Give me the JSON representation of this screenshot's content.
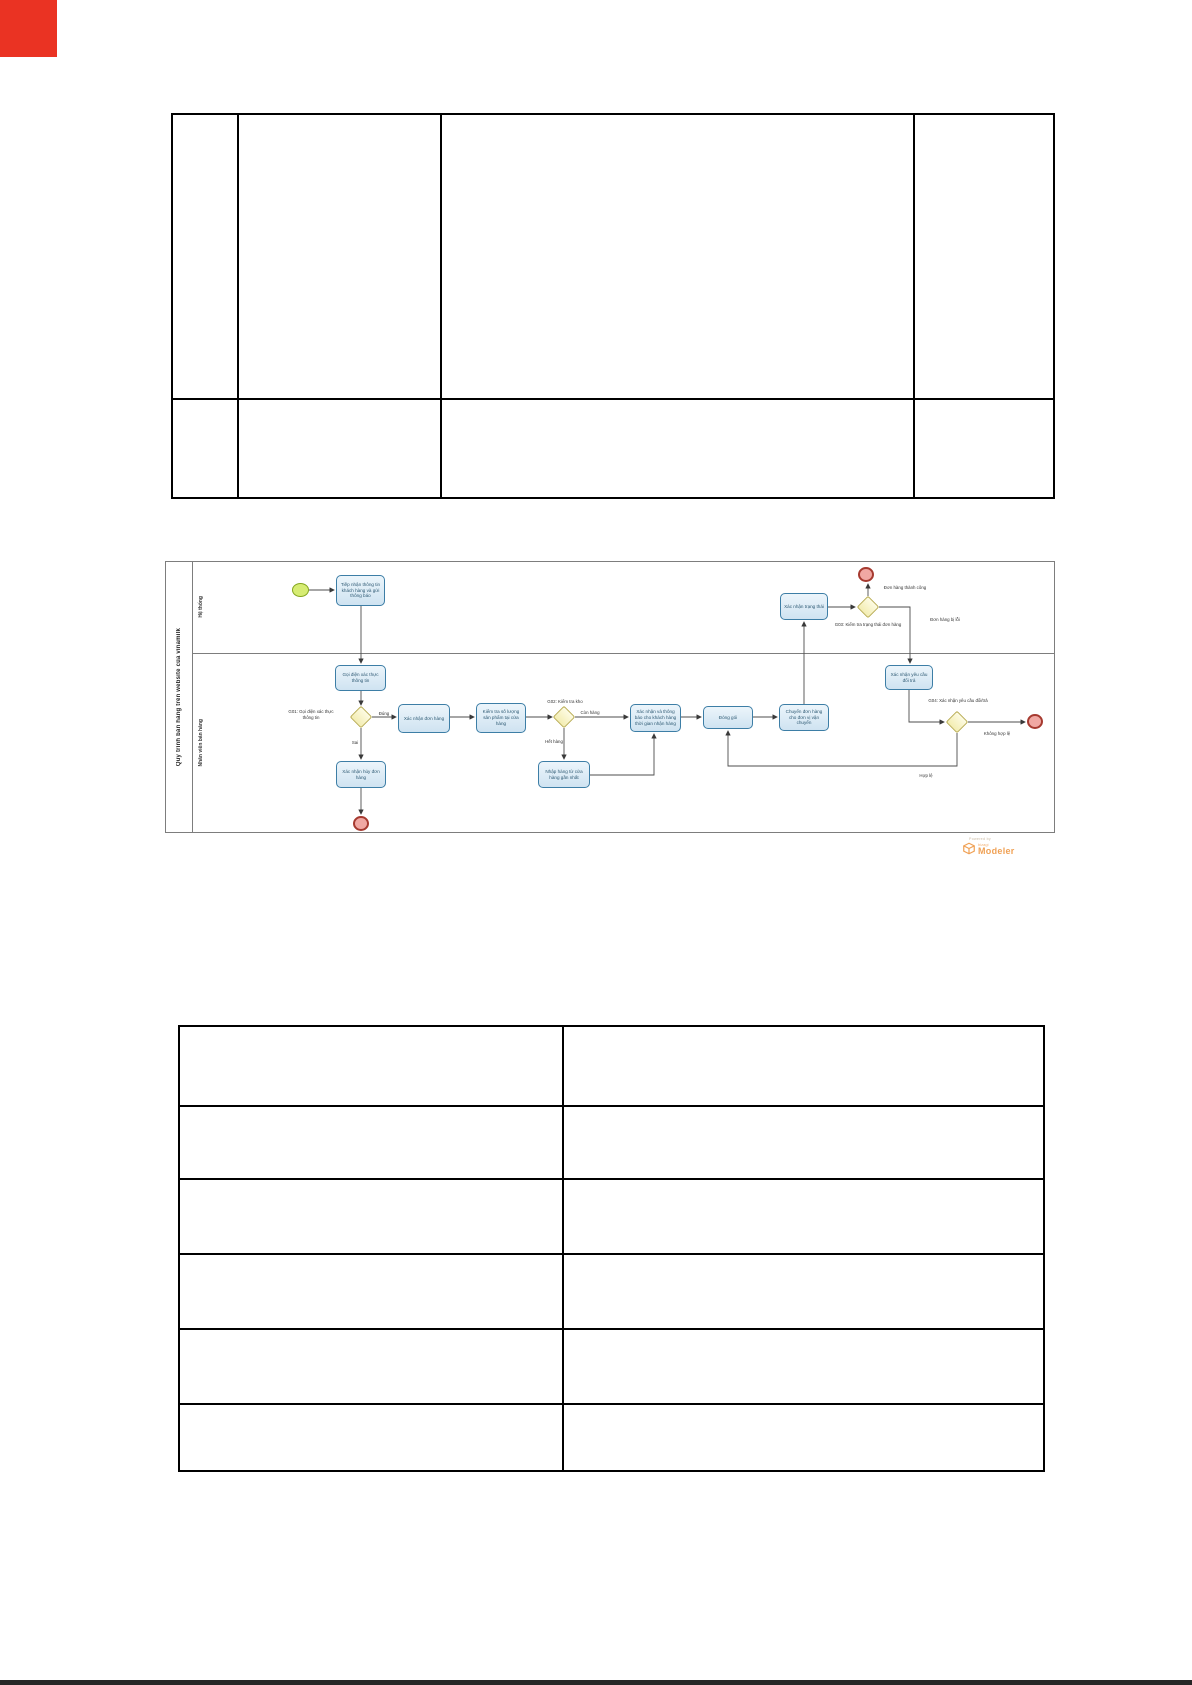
{
  "page": {
    "background": "#ffffff",
    "top_left_marker_color": "#ea3323",
    "bottom_bar_color": "#262626"
  },
  "top_table": {
    "rows": 2,
    "columns": 4,
    "all_cells_empty": true
  },
  "bottom_table": {
    "rows": 6,
    "columns": 2,
    "all_cells_empty": true
  },
  "diagram": {
    "pool_title": "Quy trình bán hàng trên website của vinamilk",
    "lanes": [
      "Hệ thống",
      "Nhân viên bán hàng"
    ],
    "tasks": {
      "t1": "Tiếp nhận thông tin khách hàng và gửi thông báo",
      "t2": "Gọi điện xác thực thông tin",
      "t3": "Xác nhận đơn hàng",
      "t4": "Kiểm tra số lượng sản phẩm tại cửa hàng",
      "t5": "Xác nhận và thông báo cho khách hàng thời gian nhận hàng",
      "t6": "Đóng gói",
      "t7": "Chuyển đơn hàng cho đơn vị vận chuyển",
      "t8": "Xác nhận trạng thái",
      "t9": "Xác nhận yêu cầu đổi trả",
      "t10": "Nhập hàng từ cửa hàng gần nhất",
      "t11": "Xác nhận hủy đơn hàng"
    },
    "gateway_captions": {
      "g01": "G01: Gọi điện xác thực thông tin",
      "g02": "G02: Kiểm tra kho",
      "g03": "G03: Kiểm tra trạng thái đơn hàng",
      "g04": "G04: Xác nhận yêu cầu đổi/trả"
    },
    "edge_labels": {
      "dung": "Đúng",
      "sai": "Sai",
      "con_hang": "Còn hàng",
      "het_hang": "Hết hàng",
      "don_hang_thanh_cong": "Đơn hàng thành công",
      "don_hang_bi_loi": "Đơn hàng bị lỗi",
      "khong_hop_le": "Không hợp lệ",
      "hop_le": "Hợp lệ"
    },
    "colors": {
      "task_fill": "#d9e9f4",
      "task_border": "#3d7ea6",
      "gateway_fill": "#f7f2c0",
      "gateway_border": "#b8ab4f",
      "start_event_fill": "#d6ec73",
      "start_event_border": "#85a71f",
      "end_event_fill": "#f0a8a3",
      "end_event_border": "#a63a30",
      "connector": "#4d4d4d",
      "pool_border": "#7d7d7d"
    },
    "logo": {
      "powered_by": "Powered by",
      "brand": "bizagi",
      "product": "Modeler",
      "color": "#f0a155"
    }
  }
}
